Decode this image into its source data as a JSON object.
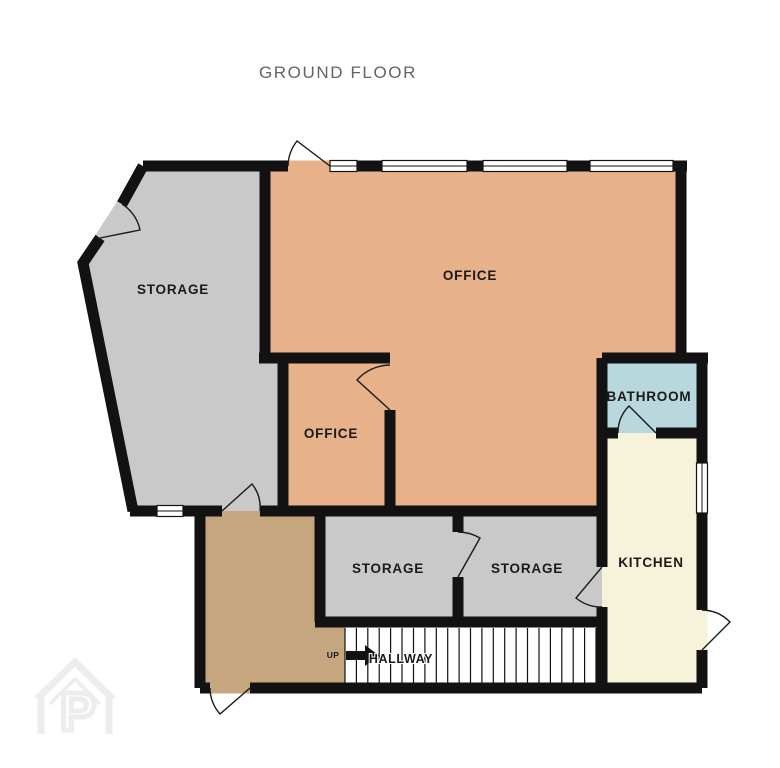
{
  "title": "GROUND FLOOR",
  "colors": {
    "wall": "#121212",
    "storage": "#c9c9c9",
    "office": "#e7b28a",
    "bathroom": "#b8d8de",
    "kitchen": "#f6f3da",
    "entry": "#c5a67e",
    "hallway": "#ffffff",
    "title_text": "#646464",
    "label_text": "#1a1a1a",
    "door_line": "#1a1a1a",
    "watermark": "#efedeb"
  },
  "rooms": {
    "storage_main": {
      "label": "STORAGE"
    },
    "office_main": {
      "label": "OFFICE"
    },
    "office_small": {
      "label": "OFFICE"
    },
    "bathroom": {
      "label": "BATHROOM"
    },
    "kitchen": {
      "label": "KITCHEN"
    },
    "storage_left": {
      "label": "STORAGE"
    },
    "storage_right": {
      "label": "STORAGE"
    },
    "hallway": {
      "label": "HALLWAY"
    }
  },
  "stairs": {
    "up_label": "UP",
    "direction": "up",
    "steps": 23
  },
  "watermark": {
    "letter": "P"
  }
}
